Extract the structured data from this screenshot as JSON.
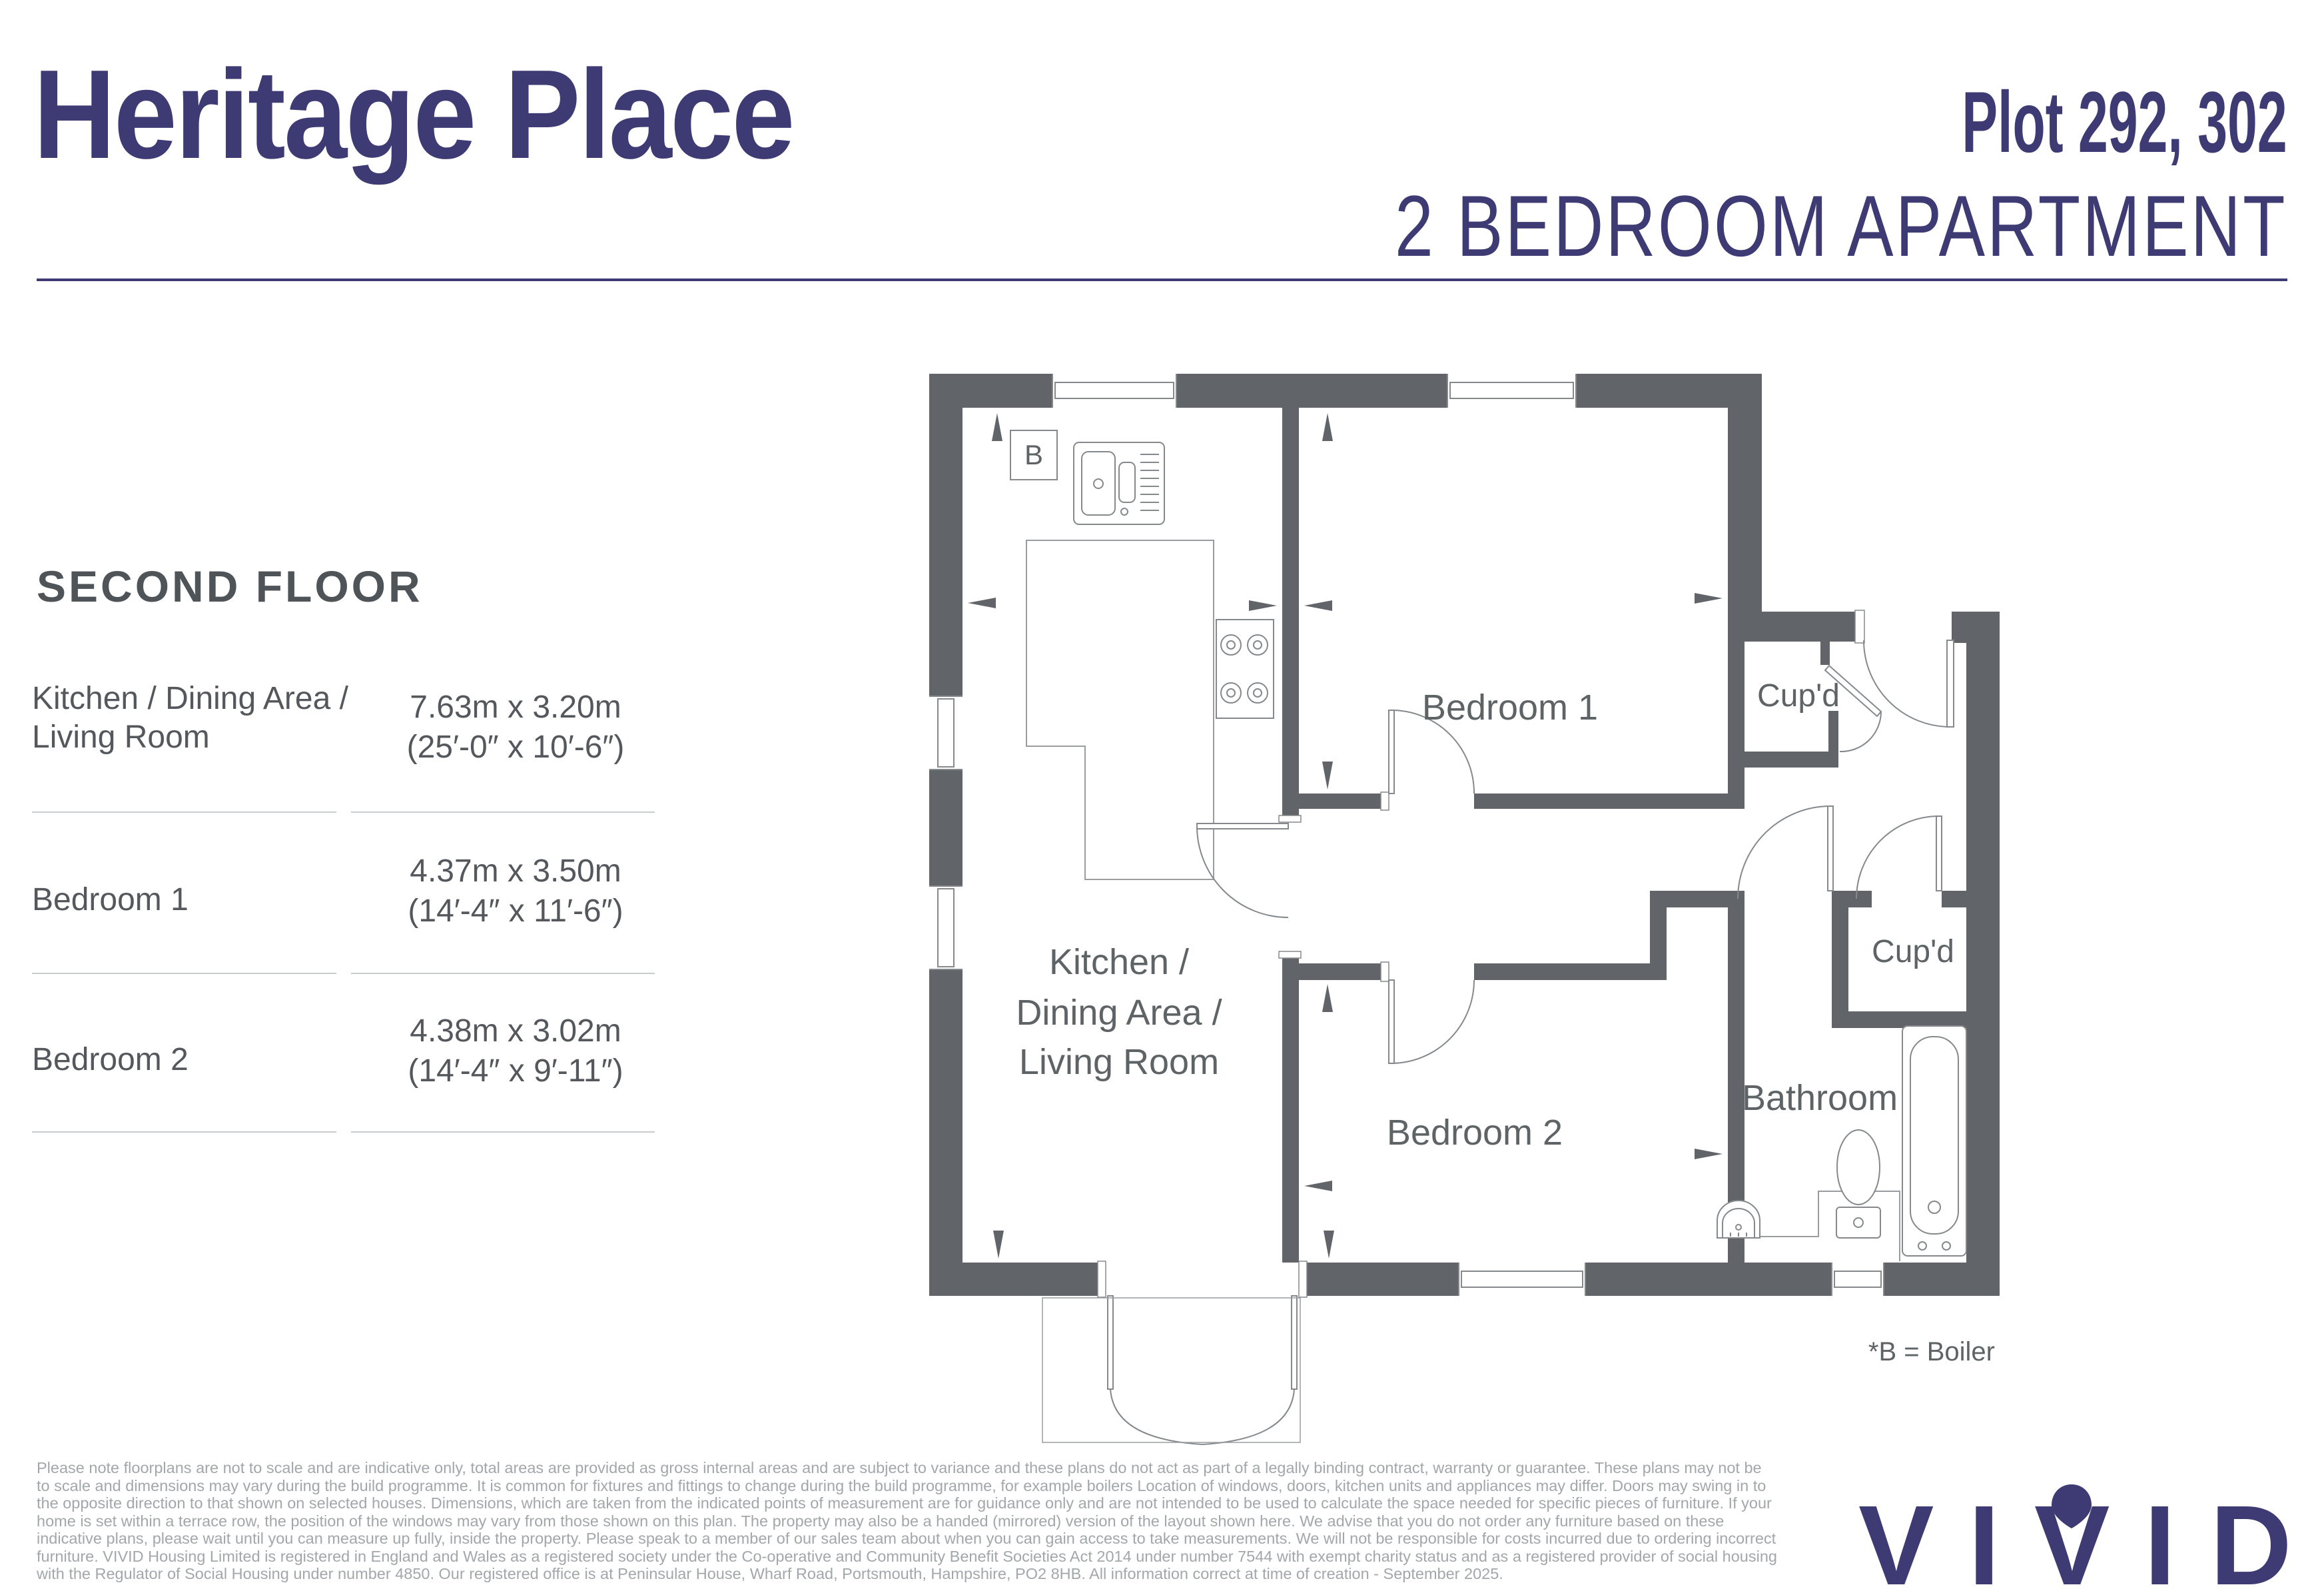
{
  "header": {
    "title": "Heritage Place",
    "plot": "Plot 292, 302",
    "subtitle": "2 BEDROOM APARTMENT"
  },
  "dimensions_panel": {
    "floor_label": "SECOND FLOOR",
    "rows": [
      {
        "room": "Kitchen / Dining Area / Living Room",
        "metric": "7.63m x 3.20m",
        "imperial": "(25′-0″ x 10′-6″)"
      },
      {
        "room": "Bedroom 1",
        "metric": "4.37m x 3.50m",
        "imperial": "(14′-4″ x 11′-6″)"
      },
      {
        "room": "Bedroom 2",
        "metric": "4.38m x 3.02m",
        "imperial": "(14′-4″ x 9′-11″)"
      }
    ]
  },
  "floorplan": {
    "labels": {
      "bedroom1": "Bedroom 1",
      "bedroom2": "Bedroom 2",
      "bathroom": "Bathroom",
      "cupboard1": "Cup'd",
      "cupboard2": "Cup'd",
      "kitchen_line1": "Kitchen /",
      "kitchen_line2": "Dining Area /",
      "kitchen_line3": "Living Room",
      "boiler_marker": "B"
    },
    "legend_note": "*B = Boiler"
  },
  "footer": {
    "disclaimer": "Please note floorplans are not to scale and are indicative only, total areas are provided as gross internal areas and are subject to variance and these plans do not act as part of a legally binding contract, warranty or guarantee. These plans may not be to scale and dimensions may vary during the build programme. It is common for fixtures and fittings to change during the build programme, for example boilers Location of windows, doors, kitchen units and appliances may differ. Doors may swing in to the opposite direction to that shown on selected houses. Dimensions, which are taken from the indicated points of measurement are for guidance only and are not intended to be used to calculate the space needed for specific pieces of furniture. If your home is set within a terrace row, the position of the windows may vary from those shown on this plan. The property may also be a handed (mirrored) version of the layout shown here. We advise that you do not order any furniture based on these indicative plans, please wait until you can measure up fully, inside the property. Please speak to a member of our sales team about when you can gain access to take measurements. We will not be responsible for costs incurred due to ordering incorrect furniture. VIVID Housing Limited is registered in England and Wales as a registered society under the Co-operative and Community Benefit Societies Act 2014 under number 7544 with exempt charity status and as a registered provider of social housing with the Regulator of Social Housing under number 4850. Our registered office is at Peninsular House, Wharf Road, Portsmouth, Hampshire, PO2 8HB. All information correct at time of creation - September 2025.",
    "logo_letters": [
      "V",
      "I",
      "V",
      "I",
      "D"
    ]
  },
  "colors": {
    "brand_navy": "#3E3A73",
    "wall_gray": "#616569",
    "label_gray": "#5E6366",
    "text_gray": "#54585C",
    "muted_gray": "#A2A7AA"
  }
}
